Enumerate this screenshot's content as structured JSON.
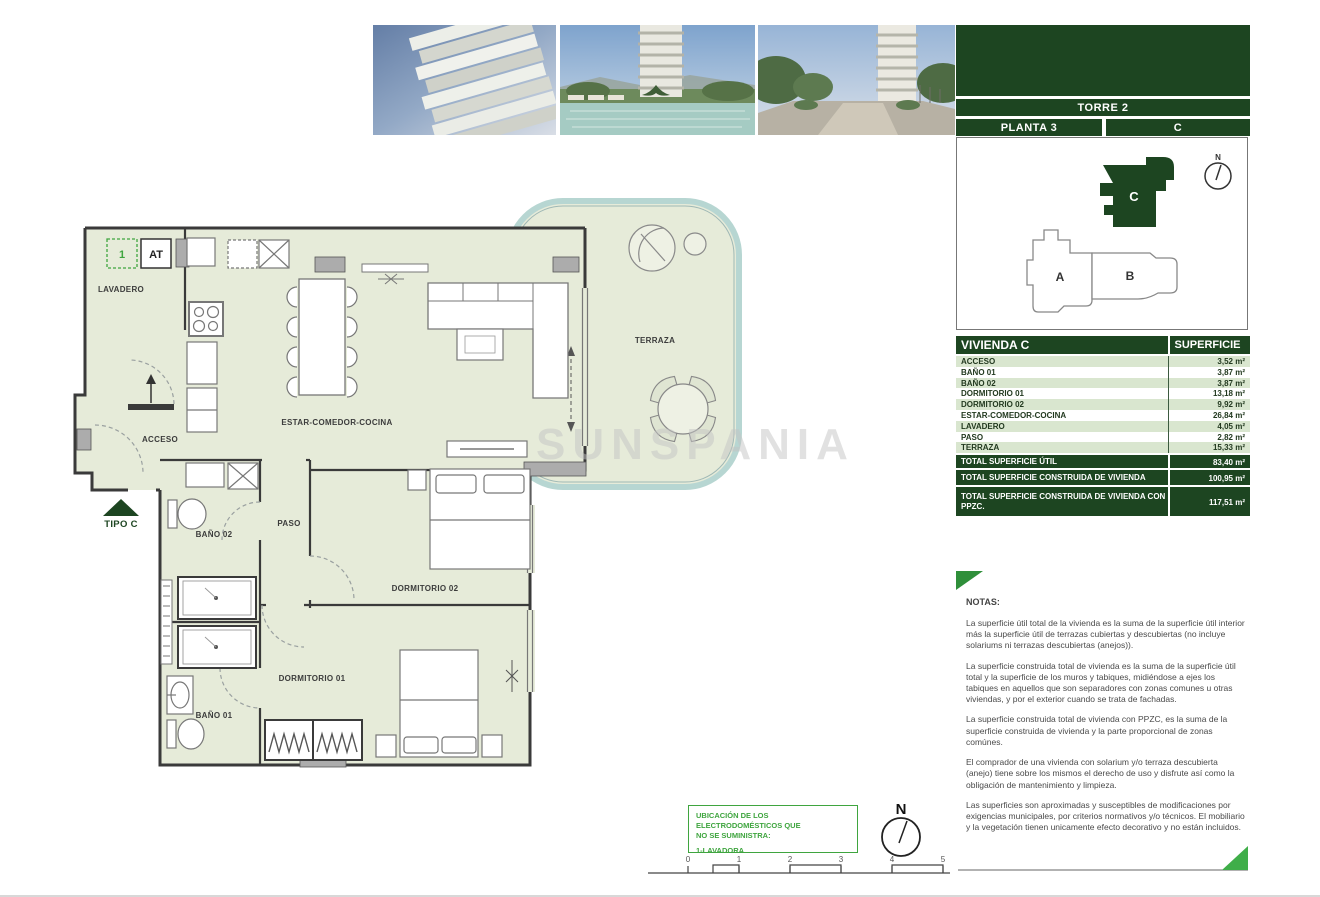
{
  "watermark": "SUNSPANIA",
  "header": {
    "torre": "TORRE 2",
    "planta": "PLANTA 3",
    "unidad": "C"
  },
  "keyplan": {
    "a": "A",
    "b": "B",
    "c": "C",
    "north": "N"
  },
  "table": {
    "title": "VIVIENDA C",
    "col": "SUPERFICIE",
    "rows": [
      {
        "label": "ACCESO",
        "value": "3,52 m²"
      },
      {
        "label": "BAÑO 01",
        "value": "3,87 m²"
      },
      {
        "label": "BAÑO 02",
        "value": "3,87 m²"
      },
      {
        "label": "DORMITORIO 01",
        "value": "13,18 m²"
      },
      {
        "label": "DORMITORIO 02",
        "value": "9,92 m²"
      },
      {
        "label": "ESTAR-COMEDOR-COCINA",
        "value": "26,84 m²"
      },
      {
        "label": "LAVADERO",
        "value": "4,05 m²"
      },
      {
        "label": "PASO",
        "value": "2,82 m²"
      },
      {
        "label": "TERRAZA",
        "value": "15,33 m²"
      }
    ],
    "totals": [
      {
        "label": "TOTAL SUPERFICIE ÚTIL",
        "value": "83,40 m²"
      },
      {
        "label": "TOTAL SUPERFICIE CONSTRUIDA DE VIVIENDA",
        "value": "100,95 m²"
      },
      {
        "label": "TOTAL SUPERFICIE CONSTRUIDA DE VIVIENDA CON PPZC.",
        "value": "117,51 m²"
      }
    ]
  },
  "notas": {
    "title": "NOTAS:",
    "paragraphs": [
      "La superficie útil total de la vivienda es la suma de la superficie útil interior más la superficie útil de terrazas cubiertas y descubiertas (no incluye solariums ni terrazas descubiertas (anejos)).",
      "La superficie construida total de vivienda es la suma de la superficie útil total y la superficie de los muros y tabiques, midiéndose a ejes los tabiques en aquellos que son separadores con zonas comunes u otras viviendas, y por el exterior cuando se trata de fachadas.",
      "La superficie construida total de vivienda con PPZC, es la suma de la superficie construida de vivienda y la parte proporcional de zonas comúnes.",
      "El comprador de una vivienda con solarium y/o terraza descubierta (anejo) tiene sobre los mismos el derecho de uso y disfrute así como la obligación de mantenimiento y limpieza.",
      "Las superficies son aproximadas y susceptibles de modificaciones por exigencias municipales, por criterios normativos y/o técnicos. El mobiliario y la vegetación tienen unicamente efecto decorativo y no están incluidos."
    ]
  },
  "plan": {
    "labels": {
      "lavadero": "LAVADERO",
      "acceso": "ACCESO",
      "estar": "ESTAR-COMEDOR-COCINA",
      "terraza": "TERRAZA",
      "paso": "PASO",
      "bano02": "BAÑO 02",
      "bano01": "BAÑO 01",
      "dorm01": "DORMITORIO 01",
      "dorm02": "DORMITORIO 02",
      "tipo": "TIPO C",
      "box1": "1",
      "boxAT": "AT"
    }
  },
  "legend": {
    "line1": "UBICACIÓN DE LOS ELECTRODOMÉSTICOS QUE",
    "line2": "NO SE SUMINISTRA:",
    "item": "1-LAVADORA"
  },
  "compass": {
    "north": "N"
  },
  "scalebar": {
    "t0": "0",
    "t1": "1",
    "t2": "2",
    "t3": "3",
    "t4": "4",
    "t5": "5"
  },
  "colors": {
    "dark_green": "#1d4521",
    "row_green": "#d9e6cf",
    "plan_fill": "#e6ebd9",
    "accent_green": "#3fa53f",
    "terrace_stroke": "#b7d6d2"
  }
}
